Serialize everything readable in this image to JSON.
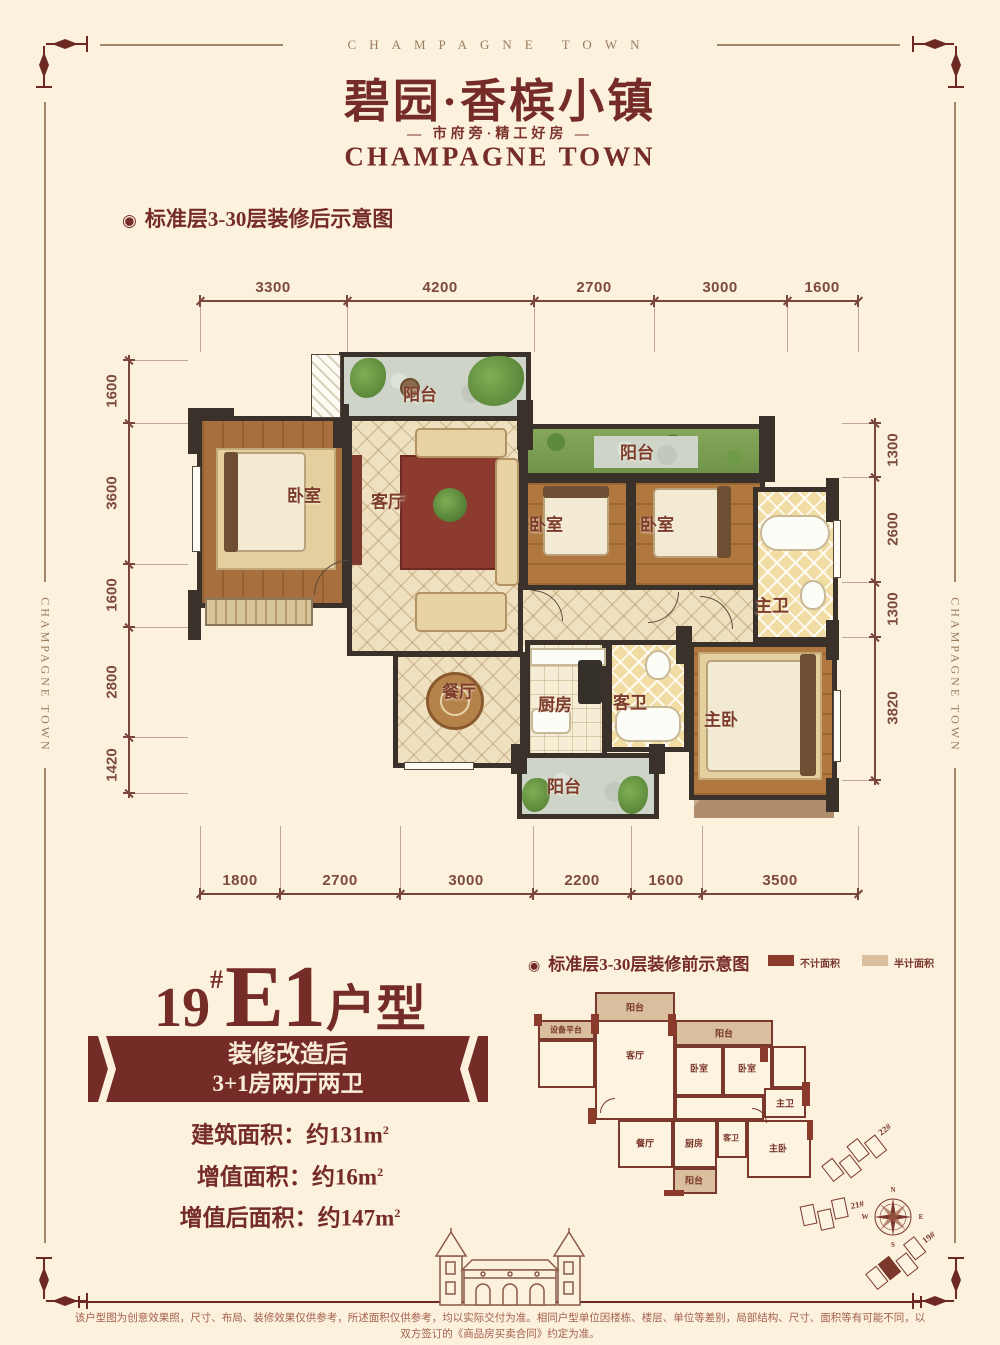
{
  "frame": {
    "banner_text": "CHAMPAGNE TOWN",
    "side_text": "CHAMPAGNE TOWN"
  },
  "header": {
    "title": "碧园·香槟小镇",
    "tagline": "— 市府旁·精工好房 —",
    "subtitle_en": "CHAMPAGNE TOWN"
  },
  "icons": {
    "bullet": "◉"
  },
  "after_plan": {
    "section_title": "标准层3-30层装修后示意图",
    "dims_top": [
      "3300",
      "4200",
      "2700",
      "3000",
      "1600"
    ],
    "dims_bottom": [
      "1800",
      "2700",
      "3000",
      "2200",
      "1600",
      "3500"
    ],
    "dims_left": [
      "1600",
      "3600",
      "1600",
      "2800",
      "1420"
    ],
    "dims_right": [
      "1300",
      "2600",
      "1300",
      "3820"
    ],
    "rooms": {
      "balcony_top": "阳台",
      "bedroom_a": "卧室",
      "living": "客厅",
      "balcony_right": "阳台",
      "bedroom_b": "卧室",
      "bedroom_c": "卧室",
      "master_bath": "主卫",
      "dining": "餐厅",
      "kitchen": "厨房",
      "guest_bath": "客卫",
      "master_bedroom": "主卧",
      "balcony_bottom": "阳台"
    }
  },
  "unit_info": {
    "building_no": "19",
    "hash": "#",
    "unit_code": "E1",
    "suffix": "户型",
    "banner_line1": "装修改造后",
    "banner_line2": "3+1房两厅两卫",
    "areas": [
      {
        "label": "建筑面积：",
        "value": "约131m",
        "sup": "2"
      },
      {
        "label": "增值面积：",
        "value": "约16m",
        "sup": "2"
      },
      {
        "label": "增值后面积：",
        "value": "约147m",
        "sup": "2"
      }
    ]
  },
  "before_plan": {
    "section_title": "标准层3-30层装修前示意图",
    "legend": [
      {
        "label": "不计面积",
        "color": "#8a3b2c"
      },
      {
        "label": "半计面积",
        "color": "#d9bf9e"
      }
    ],
    "rooms": {
      "balcony_top": "阳台",
      "equipment": "设备平台",
      "living": "客厅",
      "balcony_right": "阳台",
      "bedroom_a": "卧室",
      "bedroom_b": "卧室",
      "master_bath": "主卫",
      "dining": "餐厅",
      "kitchen": "厨房",
      "guest_bath": "客卫",
      "master_bedroom": "主卧",
      "balcony_bottom": "阳台"
    }
  },
  "site_plan": {
    "buildings": [
      {
        "label": "22#"
      },
      {
        "label": "21#"
      },
      {
        "label": "19#"
      }
    ],
    "compass": {
      "n": "N",
      "e": "E",
      "s": "S",
      "w": "W"
    }
  },
  "footer": {
    "disclaimer": "该户型图为创意效果照，尺寸、布局、装修效果仅供参考，所述面积仅供参考，均以实际交付为准。相同户型单位因楼栋、楼层、单位等差别，局部结构、尺寸、面积等有可能不同，以双方签订的《商品房买卖合同》约定为准。"
  },
  "colors": {
    "accent": "#752c27",
    "background": "#fbf1dd",
    "wall": "#3a312a",
    "dim_text": "#7d4a3e",
    "no_area": "#8a3b2c",
    "half_area": "#d9bf9e"
  }
}
